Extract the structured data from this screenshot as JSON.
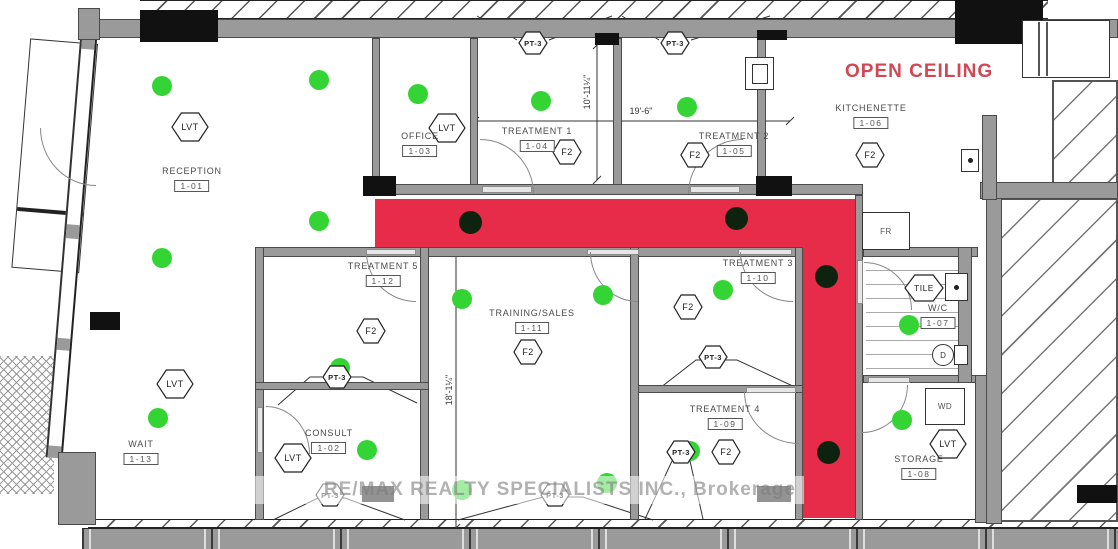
{
  "colors": {
    "highlight": "#e62c48",
    "light": "#35d435",
    "dark_dot": "#0d230d",
    "red_text": "#d04854",
    "wall": "#9a9a9a"
  },
  "annotations": {
    "open_ceiling": "OPEN CEILING",
    "watermark": "RE/MAX REALTY SPECIALISTS INC., Brokerage"
  },
  "rooms": [
    {
      "name": "RECEPTION",
      "number": "1-01",
      "x": 192,
      "y": 166
    },
    {
      "name": "OFFICE",
      "number": "1-03",
      "x": 420,
      "y": 131
    },
    {
      "name": "TREATMENT 1",
      "number": "1-04",
      "x": 537,
      "y": 126
    },
    {
      "name": "TREATMENT 2",
      "number": "1-05",
      "x": 734,
      "y": 131
    },
    {
      "name": "KITCHENETTE",
      "number": "1-06",
      "x": 871,
      "y": 103
    },
    {
      "name": "TREATMENT 5",
      "number": "1-12",
      "x": 383,
      "y": 261
    },
    {
      "name": "TRAINING/SALES",
      "number": "1-11",
      "x": 532,
      "y": 308
    },
    {
      "name": "TREATMENT 3",
      "number": "1-10",
      "x": 758,
      "y": 258
    },
    {
      "name": "W/C",
      "number": "1-07",
      "x": 938,
      "y": 303
    },
    {
      "name": "TREATMENT 4",
      "number": "1-09",
      "x": 725,
      "y": 404
    },
    {
      "name": "CONSULT",
      "number": "1-02",
      "x": 329,
      "y": 428
    },
    {
      "name": "WAIT",
      "number": "1-13",
      "x": 141,
      "y": 439
    },
    {
      "name": "STORAGE",
      "number": "1-08",
      "x": 919,
      "y": 454
    }
  ],
  "finish_tags": [
    {
      "type": "LVT",
      "x": 190,
      "y": 127
    },
    {
      "type": "LVT",
      "x": 447,
      "y": 128
    },
    {
      "type": "LVT",
      "x": 175,
      "y": 384
    },
    {
      "type": "LVT",
      "x": 293,
      "y": 458
    },
    {
      "type": "LVT",
      "x": 948,
      "y": 444
    },
    {
      "type": "F2",
      "x": 567,
      "y": 152
    },
    {
      "type": "F2",
      "x": 695,
      "y": 155
    },
    {
      "type": "F2",
      "x": 870,
      "y": 155
    },
    {
      "type": "F2",
      "x": 371,
      "y": 331
    },
    {
      "type": "F2",
      "x": 528,
      "y": 352
    },
    {
      "type": "F2",
      "x": 688,
      "y": 307
    },
    {
      "type": "F2",
      "x": 726,
      "y": 452
    },
    {
      "type": "PT-3",
      "x": 533,
      "y": 43
    },
    {
      "type": "PT-3",
      "x": 675,
      "y": 43
    },
    {
      "type": "PT-3",
      "x": 337,
      "y": 377
    },
    {
      "type": "PT-3",
      "x": 713,
      "y": 357
    },
    {
      "type": "PT-3",
      "x": 330,
      "y": 495
    },
    {
      "type": "PT-3",
      "x": 555,
      "y": 495
    },
    {
      "type": "PT-3",
      "x": 681,
      "y": 452
    },
    {
      "type": "TILE",
      "x": 924,
      "y": 288
    }
  ],
  "lights_green": [
    [
      162,
      86
    ],
    [
      319,
      80
    ],
    [
      319,
      221
    ],
    [
      162,
      258
    ],
    [
      418,
      94
    ],
    [
      541,
      101
    ],
    [
      687,
      107
    ],
    [
      340,
      368
    ],
    [
      462,
      299
    ],
    [
      603,
      295
    ],
    [
      723,
      290
    ],
    [
      158,
      418
    ],
    [
      367,
      450
    ],
    [
      462,
      490
    ],
    [
      607,
      483
    ],
    [
      690,
      451
    ],
    [
      909,
      325
    ],
    [
      902,
      420
    ]
  ],
  "dots_dark": [
    [
      470,
      222
    ],
    [
      736,
      218
    ],
    [
      826,
      276
    ],
    [
      828,
      452
    ]
  ],
  "dimensions": [
    {
      "text": "19'-6\"",
      "x": 641,
      "y": 111,
      "rot": 0
    },
    {
      "text": "10'-11¼\"",
      "x": 587,
      "y": 92,
      "rot": -90
    },
    {
      "text": "18'-1¼\"",
      "x": 449,
      "y": 390,
      "rot": -90
    }
  ],
  "fixtures": {
    "fridge": "FR",
    "washer_dryer": "WD",
    "floor_drain": "D"
  }
}
